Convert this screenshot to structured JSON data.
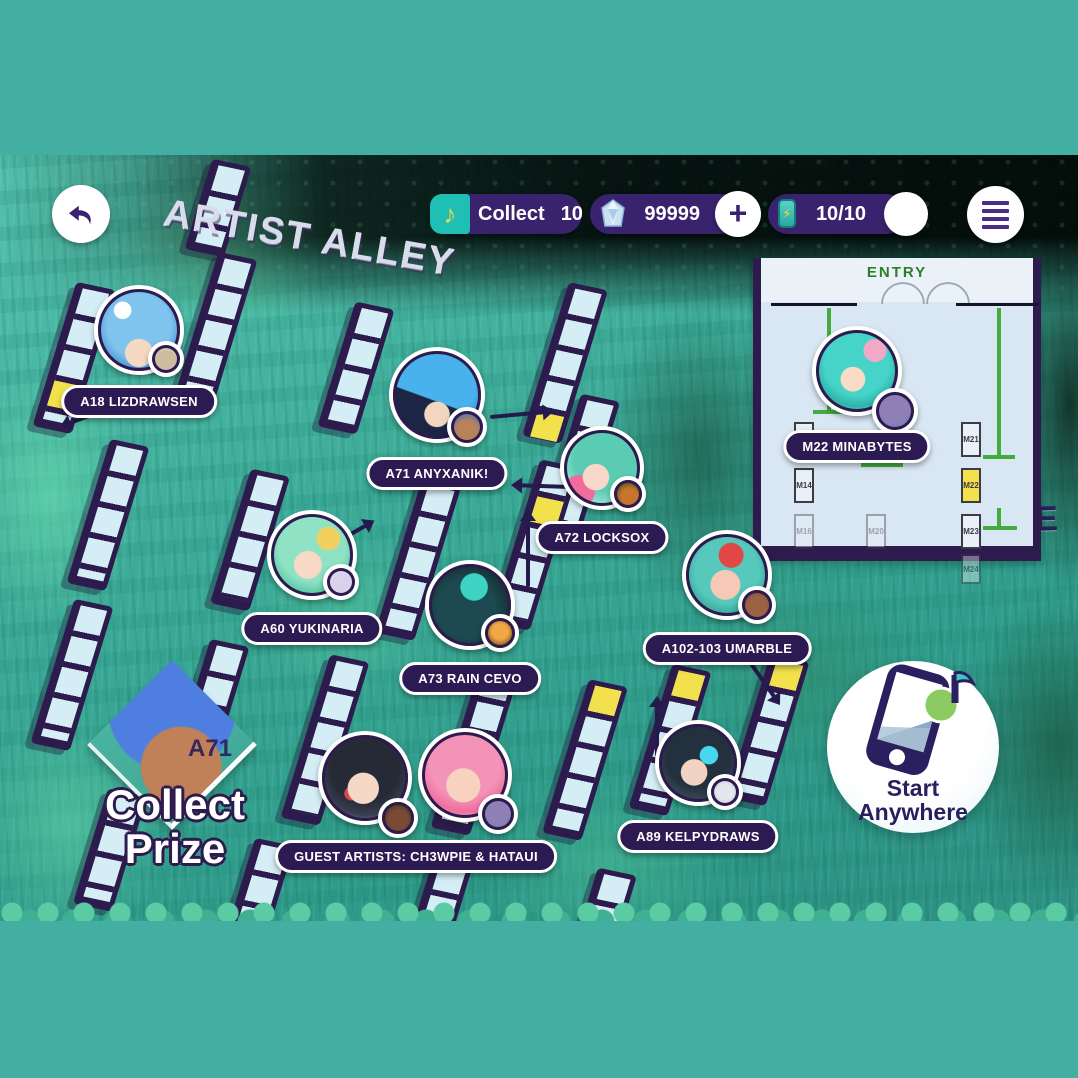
{
  "colors": {
    "frame_teal": "#43AEA2",
    "ui_purple": "#39236E",
    "pill_purple": "#2C1A52",
    "ring_purple": "#2D1B4E",
    "highlight_yellow": "#F2E14C",
    "entry_green": "#2E7D2B",
    "accent_teal": "#1FBFB4"
  },
  "topbar": {
    "collect_label": "Collect",
    "collect_count": "10",
    "currency_value": "99999",
    "currency_add": "+",
    "energy_value": "10/10"
  },
  "map": {
    "area_title": "ARTIST ALLEY",
    "booths": [
      {
        "id": "A18",
        "label": "A18 LIZDRAWSEN"
      },
      {
        "id": "A71",
        "label": "A71 ANYXANIK!"
      },
      {
        "id": "A72",
        "label": "A72 LOCKSOX"
      },
      {
        "id": "A60",
        "label": "A60 YUKINARIA"
      },
      {
        "id": "A73",
        "label": "A73 RAIN CEVO"
      },
      {
        "id": "A102-103",
        "label": "A102-103 UMARBLE"
      },
      {
        "id": "A89",
        "label": "A89 KELPYDRAWS"
      },
      {
        "id": "GUEST",
        "label": "GUEST ARTISTS: CH3WPIE & HATAUI"
      }
    ]
  },
  "minimap": {
    "title": "MARKET PLACE",
    "entry_label": "ENTRY",
    "booth_pill": "M22 MINABYTES",
    "stalls": [
      {
        "label": "M13"
      },
      {
        "label": "M14"
      },
      {
        "label": "M16"
      },
      {
        "label": "M20"
      },
      {
        "label": "M21"
      },
      {
        "label": "M22"
      },
      {
        "label": "M23"
      },
      {
        "label": "M24"
      }
    ]
  },
  "prize": {
    "booth_id": "A71",
    "line1": "Collect",
    "line2": "Prize"
  },
  "start_button": {
    "line1": "Start",
    "line2": "Anywhere"
  }
}
